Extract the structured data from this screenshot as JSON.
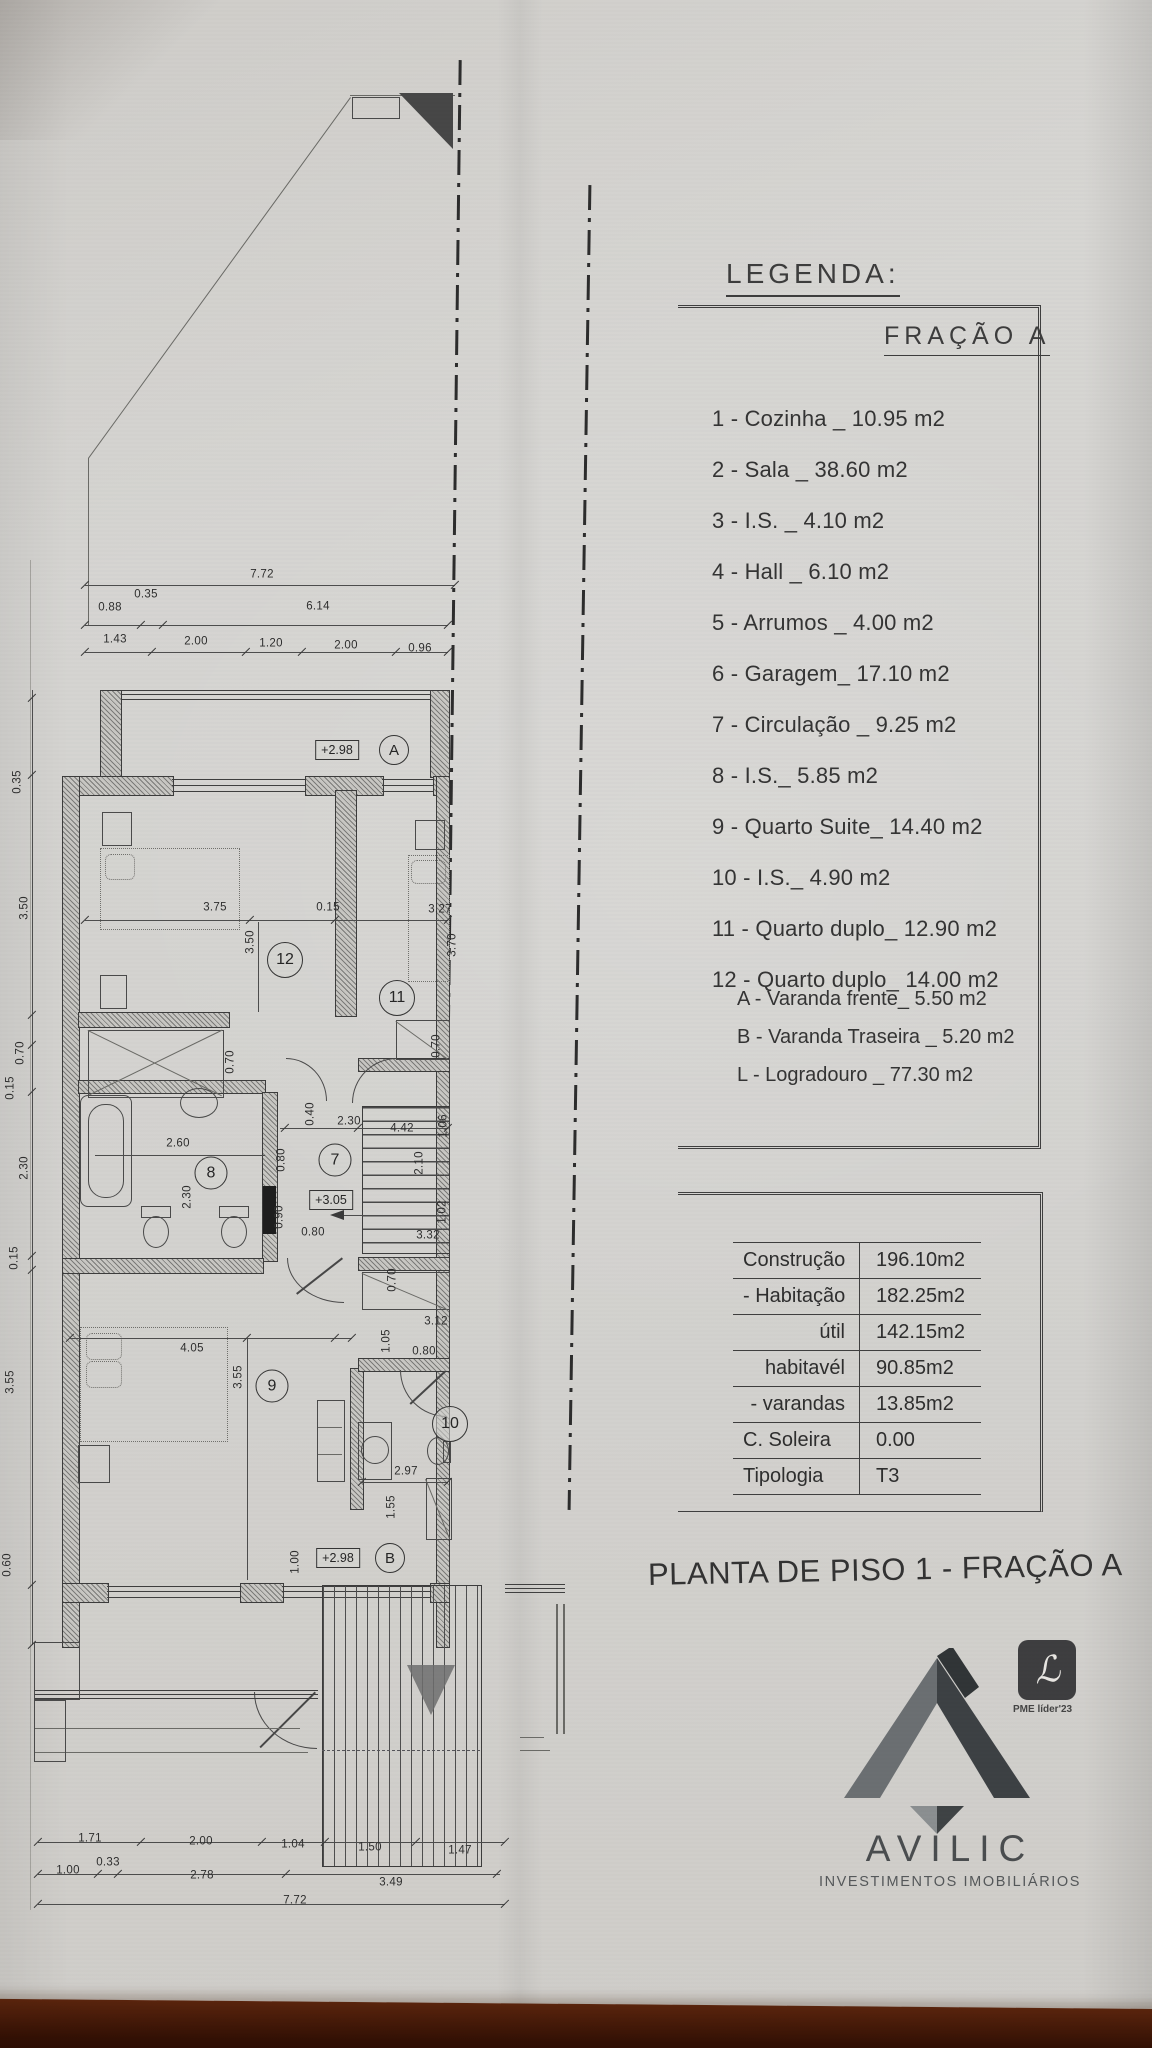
{
  "photo": {
    "paper_color": "#d6d5d2",
    "surface_color": "#3a1507",
    "ink_color": "#3c3c3c"
  },
  "legend": {
    "heading": "LEGENDA:",
    "fraction_title": "FRAÇÃO A",
    "items": [
      {
        "text": "1 - Cozinha _ 10.95 m2"
      },
      {
        "text": "2 - Sala  _ 38.60 m2"
      },
      {
        "text": "3 - I.S. _ 4.10 m2"
      },
      {
        "text": "4 - Hall _ 6.10 m2"
      },
      {
        "text": "5 - Arrumos _ 4.00 m2"
      },
      {
        "text": "6 - Garagem_ 17.10 m2"
      },
      {
        "text": "7 - Circulação _ 9.25 m2"
      },
      {
        "text": "8 - I.S._ 5.85 m2"
      },
      {
        "text": "9 - Quarto Suite_ 14.40 m2"
      },
      {
        "text": "10 - I.S._ 4.90 m2"
      },
      {
        "text": "11 - Quarto duplo_ 12.90 m2"
      },
      {
        "text": "12 - Quarto duplo_ 14.00 m2"
      }
    ],
    "sub_items": [
      {
        "text": "A - Varanda frente_ 5.50 m2"
      },
      {
        "text": "B - Varanda Traseira _ 5.20 m2"
      },
      {
        "text": "L - Logradouro _ 77.30 m2"
      }
    ]
  },
  "areas_table": {
    "rows": [
      {
        "label": "Construção",
        "value": "196.10m2"
      },
      {
        "label": "- Habitação",
        "value": "182.25m2"
      },
      {
        "label": "útil",
        "value": "142.15m2"
      },
      {
        "label": "habitavél",
        "value": "90.85m2"
      },
      {
        "label": "- varandas",
        "value": "13.85m2"
      },
      {
        "label": "C. Soleira",
        "value": "0.00"
      },
      {
        "label": "Tipologia",
        "value": "T3"
      }
    ]
  },
  "sheet_title": "PLANTA DE PISO 1 - FRAÇÃO A",
  "logo": {
    "name": "AVILIC",
    "subtitle": "INVESTIMENTOS IMOBILIÁRIOS",
    "badge": "PME líder'23"
  },
  "plan": {
    "levels": [
      {
        "t": "+2.98",
        "x": 337,
        "y": 750
      },
      {
        "t": "+3.05",
        "x": 331,
        "y": 1200
      },
      {
        "t": "+2.98",
        "x": 338,
        "y": 1558
      }
    ],
    "rooms": [
      {
        "n": "A",
        "x": 394,
        "y": 750,
        "d": 28
      },
      {
        "n": "12",
        "x": 285,
        "y": 960,
        "d": 34
      },
      {
        "n": "11",
        "x": 397,
        "y": 998,
        "d": 34
      },
      {
        "n": "7",
        "x": 335,
        "y": 1160,
        "d": 31
      },
      {
        "n": "8",
        "x": 211,
        "y": 1173,
        "d": 31
      },
      {
        "n": "9",
        "x": 272,
        "y": 1386,
        "d": 31
      },
      {
        "n": "10",
        "x": 450,
        "y": 1424,
        "d": 34
      },
      {
        "n": "B",
        "x": 390,
        "y": 1558,
        "d": 28
      }
    ],
    "dims": [
      {
        "t": "7.72",
        "x": 262,
        "y": 575
      },
      {
        "t": "0.88",
        "x": 110,
        "y": 608
      },
      {
        "t": "0.35",
        "x": 146,
        "y": 595
      },
      {
        "t": "6.14",
        "x": 318,
        "y": 607
      },
      {
        "t": "1.43",
        "x": 115,
        "y": 640
      },
      {
        "t": "2.00",
        "x": 196,
        "y": 642
      },
      {
        "t": "1.20",
        "x": 271,
        "y": 644
      },
      {
        "t": "2.00",
        "x": 346,
        "y": 646
      },
      {
        "t": "0.96",
        "x": 420,
        "y": 649
      },
      {
        "t": "0.35",
        "x": 18,
        "y": 782,
        "r": 1
      },
      {
        "t": "3.50",
        "x": 25,
        "y": 908,
        "r": 1
      },
      {
        "t": "0.70",
        "x": 21,
        "y": 1053,
        "r": 1
      },
      {
        "t": "0.15",
        "x": 11,
        "y": 1088,
        "r": 1
      },
      {
        "t": "2.30",
        "x": 25,
        "y": 1168,
        "r": 1
      },
      {
        "t": "0.15",
        "x": 15,
        "y": 1258,
        "r": 1
      },
      {
        "t": "3.55",
        "x": 11,
        "y": 1382,
        "r": 1
      },
      {
        "t": "0.60",
        "x": 8,
        "y": 1565,
        "r": 1
      },
      {
        "t": "3.75",
        "x": 215,
        "y": 908
      },
      {
        "t": "0.15",
        "x": 328,
        "y": 908
      },
      {
        "t": "3.27",
        "x": 440,
        "y": 910
      },
      {
        "t": "3.50",
        "x": 251,
        "y": 942,
        "r": 1
      },
      {
        "t": "3.70",
        "x": 453,
        "y": 945,
        "r": 1
      },
      {
        "t": "0.70",
        "x": 231,
        "y": 1062,
        "r": 1
      },
      {
        "t": "0.70",
        "x": 437,
        "y": 1046,
        "r": 1
      },
      {
        "t": "0.40",
        "x": 311,
        "y": 1114,
        "r": 1
      },
      {
        "t": "2.30",
        "x": 349,
        "y": 1122
      },
      {
        "t": "4.42",
        "x": 402,
        "y": 1129
      },
      {
        "t": "2.60",
        "x": 178,
        "y": 1144
      },
      {
        "t": "2.30",
        "x": 188,
        "y": 1197,
        "r": 1
      },
      {
        "t": "0.80",
        "x": 282,
        "y": 1160,
        "r": 1
      },
      {
        "t": "0.90",
        "x": 280,
        "y": 1217,
        "r": 1
      },
      {
        "t": "0.80",
        "x": 313,
        "y": 1233
      },
      {
        "t": "2.10",
        "x": 420,
        "y": 1163,
        "r": 1
      },
      {
        "t": "1.06",
        "x": 444,
        "y": 1126,
        "r": 1
      },
      {
        "t": "1.02",
        "x": 443,
        "y": 1212,
        "r": 1
      },
      {
        "t": "3.32",
        "x": 428,
        "y": 1236
      },
      {
        "t": "0.70",
        "x": 393,
        "y": 1280,
        "r": 1
      },
      {
        "t": "4.05",
        "x": 192,
        "y": 1349
      },
      {
        "t": "3.55",
        "x": 239,
        "y": 1377,
        "r": 1
      },
      {
        "t": "1.05",
        "x": 387,
        "y": 1341,
        "r": 1
      },
      {
        "t": "3.12",
        "x": 436,
        "y": 1322
      },
      {
        "t": "0.80",
        "x": 424,
        "y": 1352
      },
      {
        "t": "2.97",
        "x": 406,
        "y": 1472
      },
      {
        "t": "1.55",
        "x": 392,
        "y": 1507,
        "r": 1
      },
      {
        "t": "1.00",
        "x": 296,
        "y": 1562,
        "r": 1
      },
      {
        "t": "1.71",
        "x": 90,
        "y": 1839
      },
      {
        "t": "2.00",
        "x": 201,
        "y": 1842
      },
      {
        "t": "1.04",
        "x": 293,
        "y": 1845
      },
      {
        "t": "1.50",
        "x": 370,
        "y": 1848
      },
      {
        "t": "1.47",
        "x": 460,
        "y": 1851
      },
      {
        "t": "1.00",
        "x": 68,
        "y": 1871
      },
      {
        "t": "0.33",
        "x": 108,
        "y": 1863
      },
      {
        "t": "2.78",
        "x": 202,
        "y": 1876
      },
      {
        "t": "3.49",
        "x": 391,
        "y": 1883
      },
      {
        "t": "7.72",
        "x": 295,
        "y": 1901
      }
    ]
  }
}
